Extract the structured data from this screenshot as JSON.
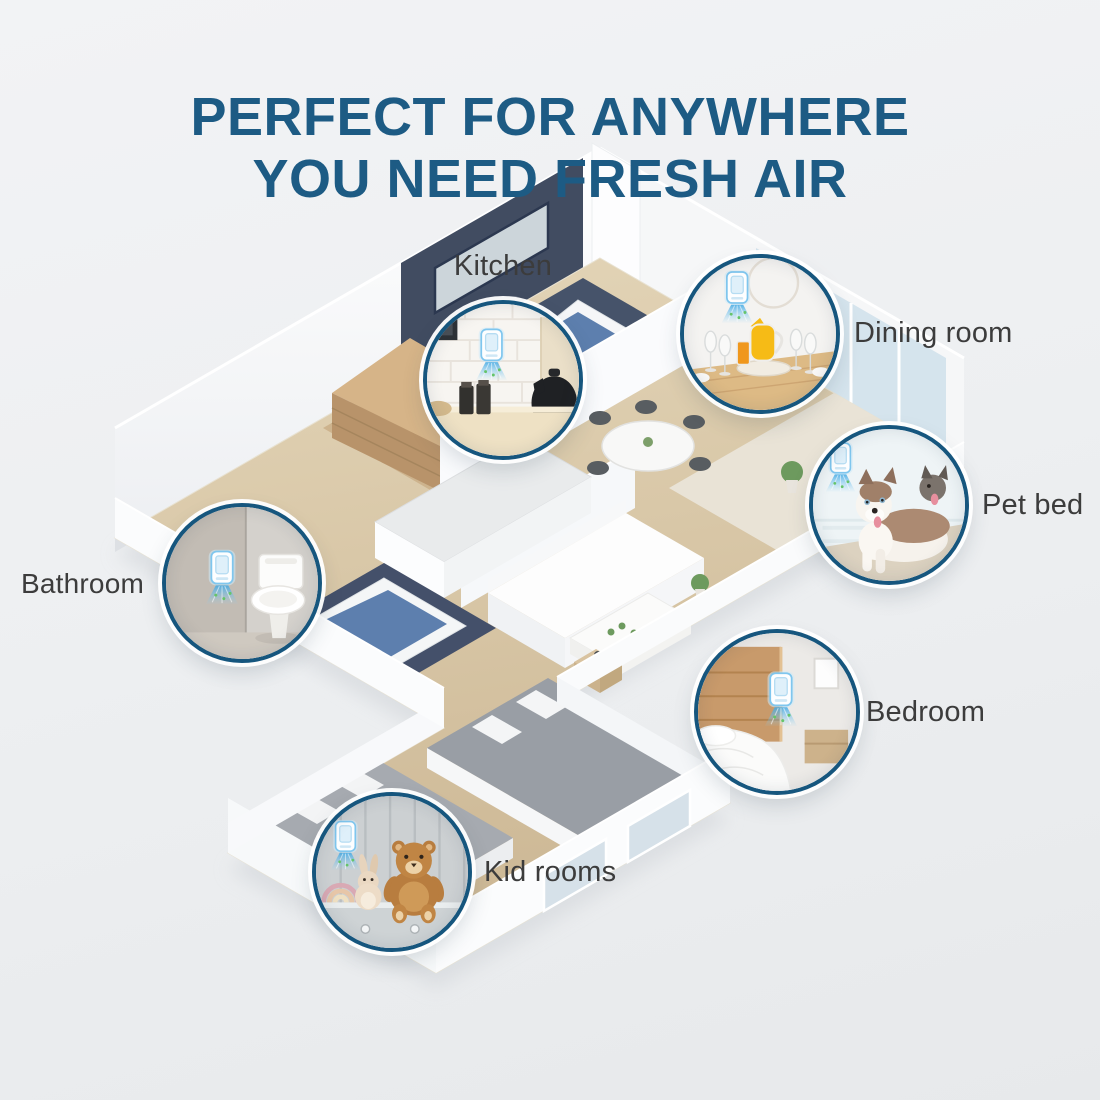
{
  "title": {
    "line1": "PERFECT FOR ANYWHERE",
    "line2": "YOU NEED FRESH AIR"
  },
  "callouts": [
    {
      "id": "kitchen",
      "label": "Kitchen"
    },
    {
      "id": "dining-room",
      "label": "Dining room"
    },
    {
      "id": "pet-bed",
      "label": "Pet bed"
    },
    {
      "id": "bathroom",
      "label": "Bathroom"
    },
    {
      "id": "bedroom",
      "label": "Bedroom"
    },
    {
      "id": "kid-rooms",
      "label": "Kid rooms"
    }
  ],
  "device": {
    "name": "plug-in air purifier with blue mist"
  },
  "colors": {
    "title": "#1d5b84",
    "circle_border": "#16567e",
    "label": "#3c3c3c",
    "background": "#eef0f2",
    "mist": "#4fb1e8",
    "wood_floor": "#d7c5a4",
    "navy_wall": "#414c61"
  }
}
